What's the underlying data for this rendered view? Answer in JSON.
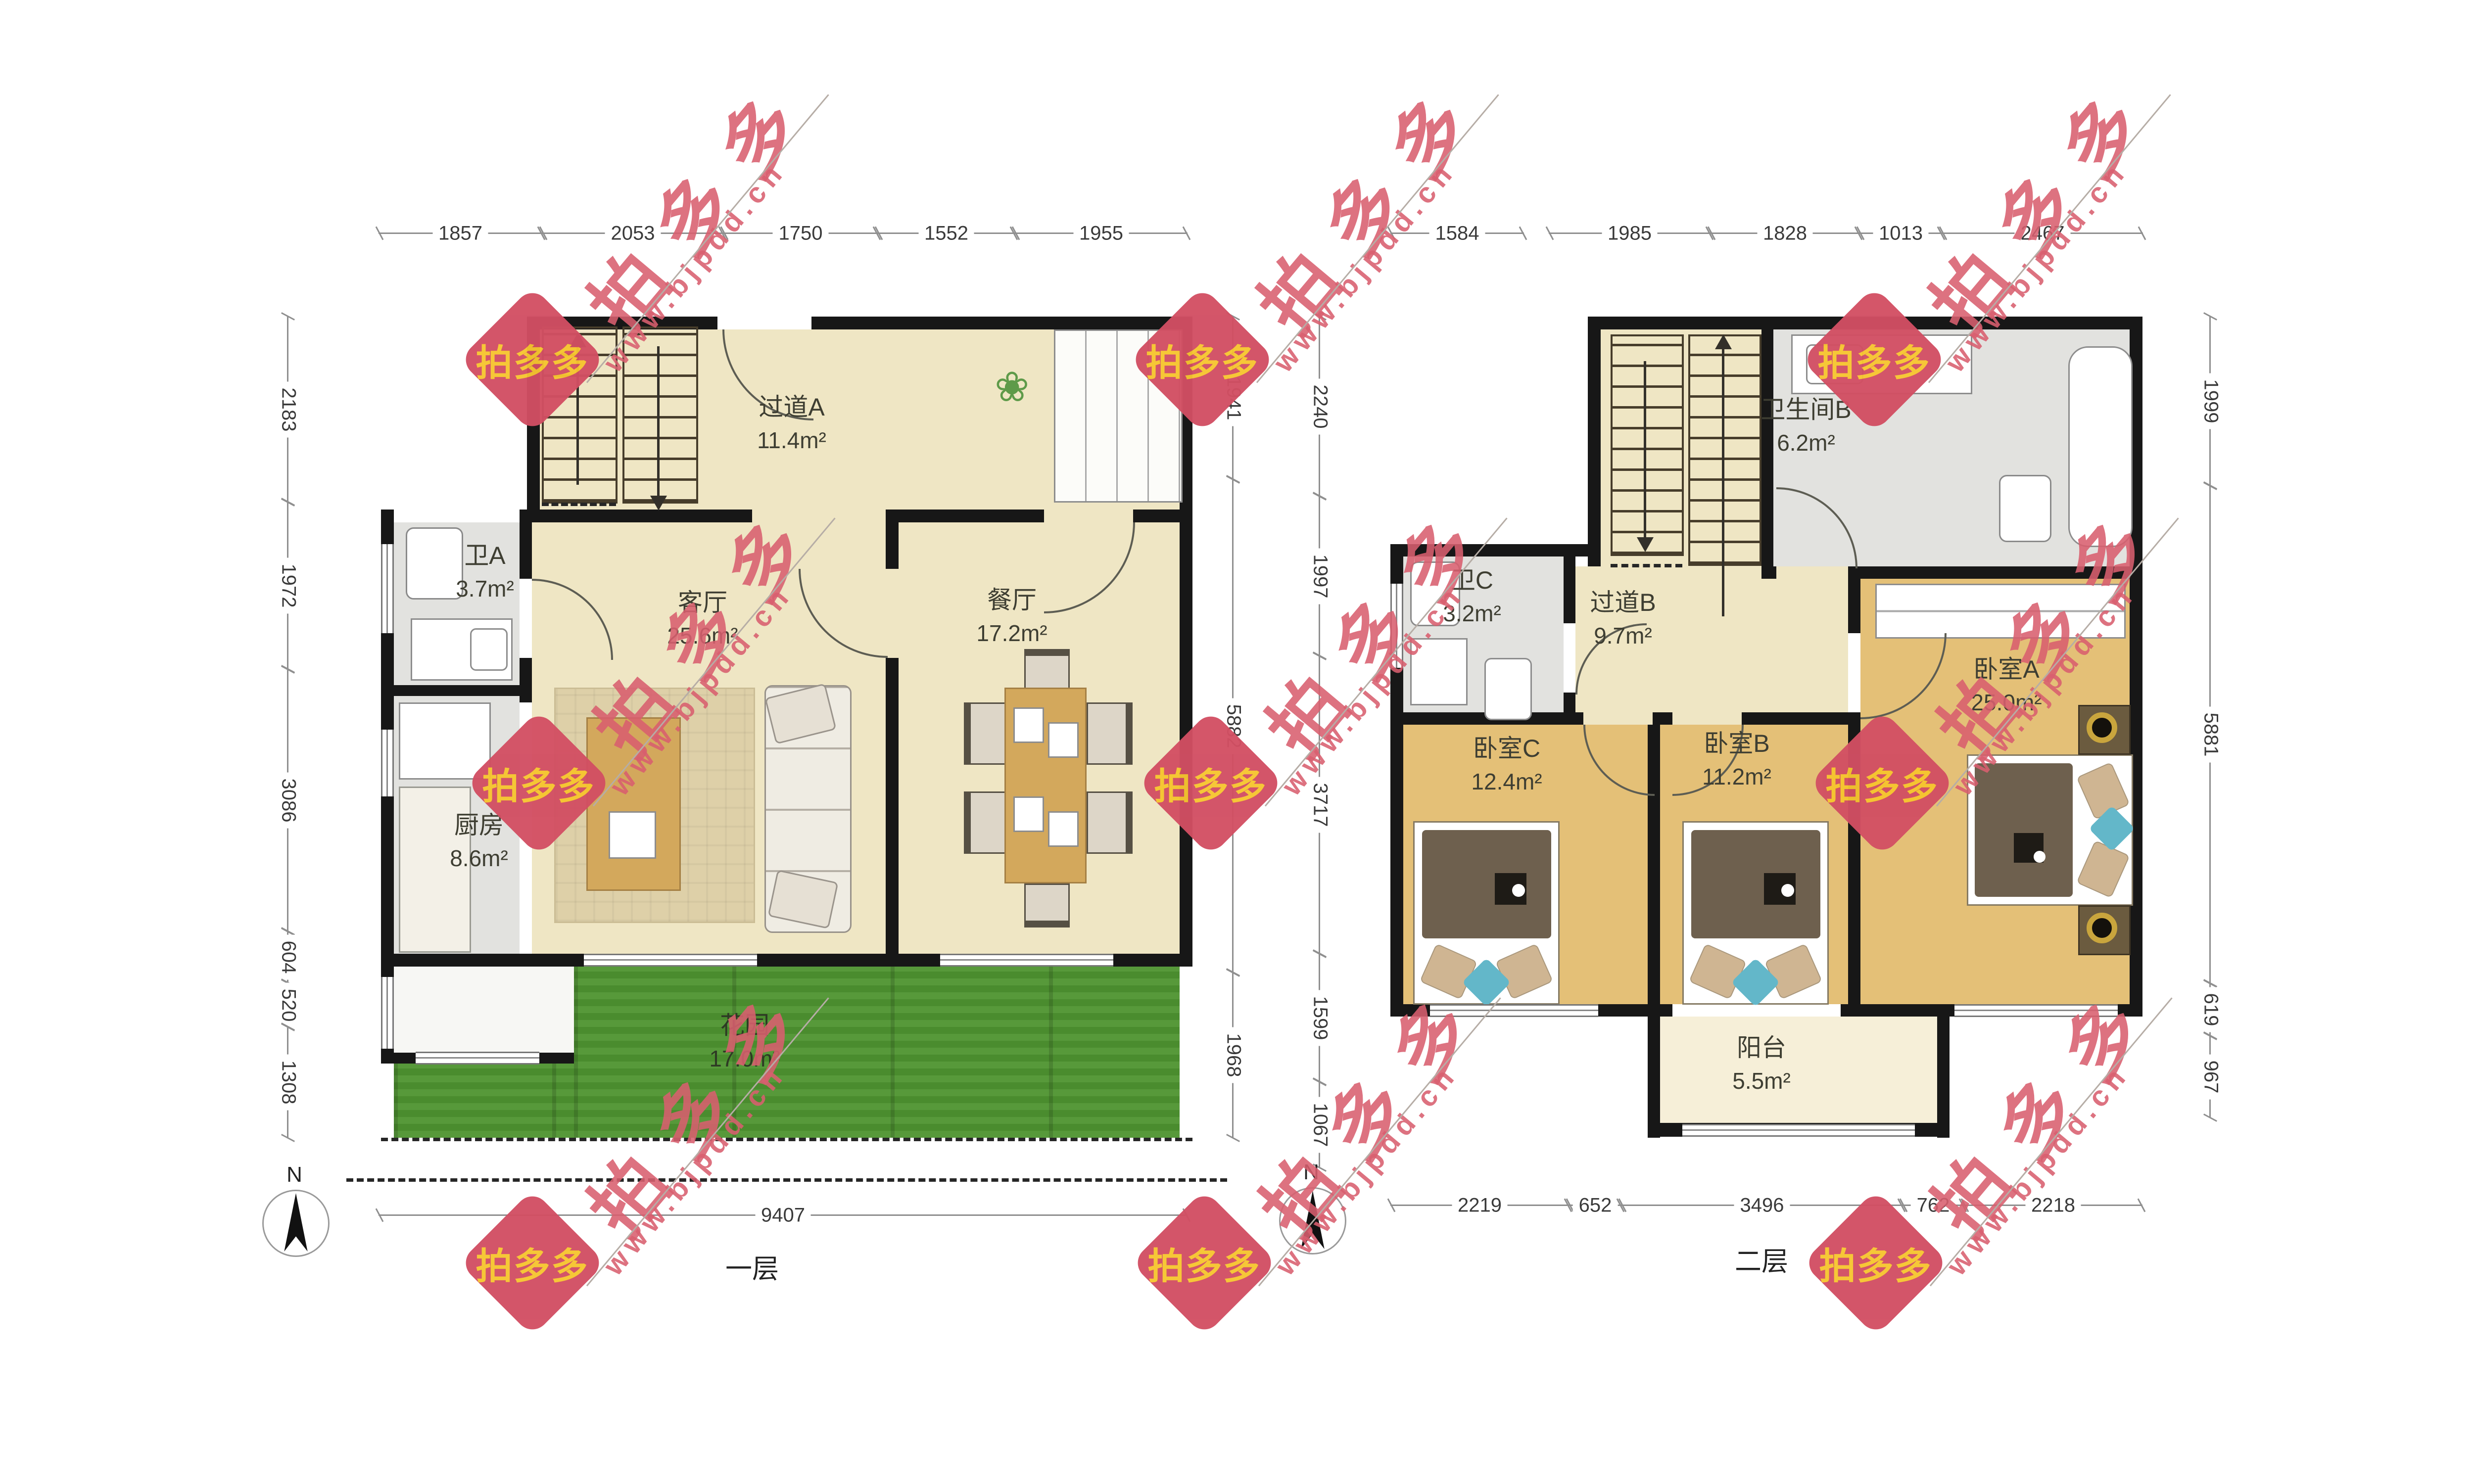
{
  "meta": {
    "type": "floor-plan",
    "floors": 2
  },
  "watermark": {
    "brand": "拍多多",
    "url": "www.bjpdd.cn"
  },
  "compass": {
    "label": "N"
  },
  "colors": {
    "wall": "#171717",
    "floor_beige": "#efe6c4",
    "floor_wood": "#e4c077",
    "floor_tile": "#e2e2df",
    "garden_green": "#4e9430",
    "balcony_cream": "#f6efd8",
    "watermark_red": "#d9536a",
    "logo_yellow": "#f6c52f"
  },
  "floor1": {
    "label": "一层",
    "rooms": {
      "hallway_a": {
        "name": "过道A",
        "area": "11.4m²"
      },
      "bath_a": {
        "name": "卫A",
        "area": "3.7m²"
      },
      "living": {
        "name": "客厅",
        "area": "25.6m²"
      },
      "dining": {
        "name": "餐厅",
        "area": "17.2m²"
      },
      "kitchen": {
        "name": "厨房",
        "area": "8.6m²"
      },
      "garden": {
        "name": "花园",
        "area": "17.0m²"
      }
    },
    "dims": {
      "top": [
        "1857",
        "2053",
        "1750",
        "1552",
        "1955"
      ],
      "left": [
        "2183",
        "1972",
        "3086",
        "604",
        "520",
        "1308"
      ],
      "right_inner": [
        "1941",
        "5882",
        "1968"
      ],
      "bottom": [
        "9407"
      ]
    }
  },
  "floor2": {
    "label": "二层",
    "rooms": {
      "bath_b": {
        "name": "卫生间B",
        "area": "6.2m²"
      },
      "bath_c": {
        "name": "卫C",
        "area": "3.2m²"
      },
      "hallway_b": {
        "name": "过道B",
        "area": "9.7m²"
      },
      "bedroom_c": {
        "name": "卧室C",
        "area": "12.4m²"
      },
      "bedroom_b": {
        "name": "卧室B",
        "area": "11.2m²"
      },
      "bedroom_a": {
        "name": "卧室A",
        "area": "25.0m²"
      },
      "balcony": {
        "name": "阳台",
        "area": "5.5m²"
      }
    },
    "dims": {
      "left_inner": [
        "2240",
        "1997",
        "3717",
        "1599",
        "1067"
      ],
      "top": [
        "1584",
        "1985",
        "1828",
        "1013",
        "2467"
      ],
      "right": [
        "1999",
        "5881",
        "619",
        "967"
      ],
      "bottom": [
        "2219",
        "652",
        "3496",
        "762",
        "2218"
      ]
    }
  }
}
